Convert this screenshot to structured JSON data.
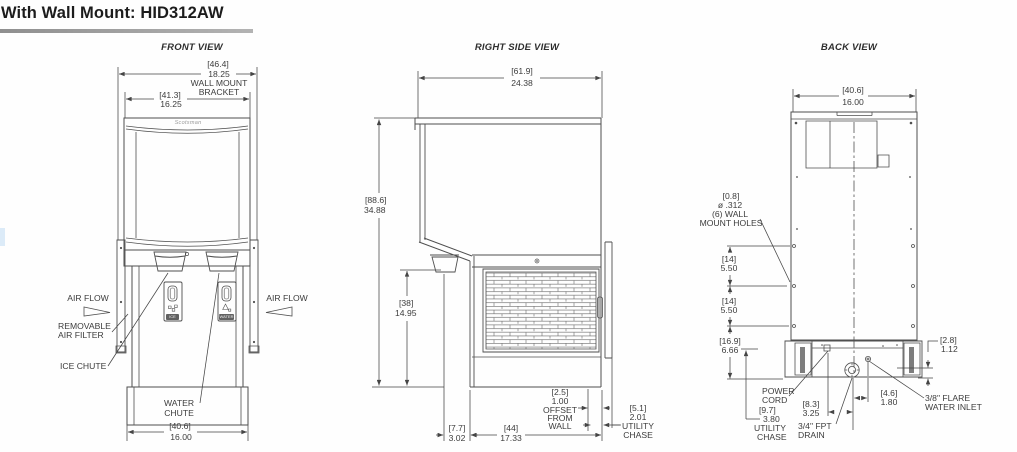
{
  "header": {
    "title": "With Wall Mount: HID312AW"
  },
  "front": {
    "title": "FRONT VIEW",
    "brand": "Scotsman",
    "bracket_width": {
      "mm": "[46.4]",
      "inch": "18.25",
      "note1": "WALL MOUNT",
      "note2": "BRACKET"
    },
    "cabinet_width": {
      "mm": "[41.3]",
      "inch": "16.25"
    },
    "base_width": {
      "mm": "[40.6]",
      "inch": "16.00"
    },
    "air_flow_left": "AIR FLOW",
    "air_flow_right": "AIR FLOW",
    "air_filter_1": "REMOVABLE",
    "air_filter_2": "AIR FILTER",
    "ice_chute": "ICE CHUTE",
    "water_chute_1": "WATER",
    "water_chute_2": "CHUTE",
    "panel_ice": "ICE",
    "panel_water": "WATER"
  },
  "right": {
    "title": "RIGHT SIDE VIEW",
    "depth": {
      "mm": "[61.9]",
      "inch": "24.38"
    },
    "height": {
      "mm": "[88.6]",
      "inch": "34.88"
    },
    "grille_height": {
      "mm": "[38]",
      "inch": "14.95"
    },
    "chute_offset": {
      "mm": "[7.7]",
      "inch": "3.02"
    },
    "body_depth": {
      "mm": "[44]",
      "inch": "17.33"
    },
    "wall_offset": {
      "mm": "[2.5]",
      "inch": "1.00",
      "note1": "OFFSET",
      "note2": "FROM",
      "note3": "WALL"
    },
    "utility_chase": {
      "mm": "[5.1]",
      "inch": "2.01",
      "note1": "UTILITY",
      "note2": "CHASE"
    }
  },
  "back": {
    "title": "BACK VIEW",
    "width": {
      "mm": "[40.6]",
      "inch": "16.00"
    },
    "mount_holes": {
      "mm": "[0.8]",
      "dia": "ø .312",
      "note1": "(6) WALL",
      "note2": "MOUNT HOLES"
    },
    "hole_gap_1": {
      "mm": "[14]",
      "inch": "5.50"
    },
    "hole_gap_2": {
      "mm": "[14]",
      "inch": "5.50"
    },
    "hole_to_base": {
      "mm": "[16.9]",
      "inch": "6.66"
    },
    "bracket_lip": {
      "mm": "[2.8]",
      "inch": "1.12"
    },
    "power_offset": {
      "mm": "[8.3]",
      "inch": "3.25"
    },
    "inlet_offset": {
      "mm": "[4.6]",
      "inch": "1.80"
    },
    "utility_chase": {
      "mm": "[9.7]",
      "inch": "3.80",
      "note1": "UTILITY",
      "note2": "CHASE"
    },
    "power_1": "POWER",
    "power_2": "CORD",
    "drain_1": "3/4\" FPT",
    "drain_2": "DRAIN",
    "inlet_1": "3/8\" FLARE",
    "inlet_2": "WATER INLET"
  }
}
